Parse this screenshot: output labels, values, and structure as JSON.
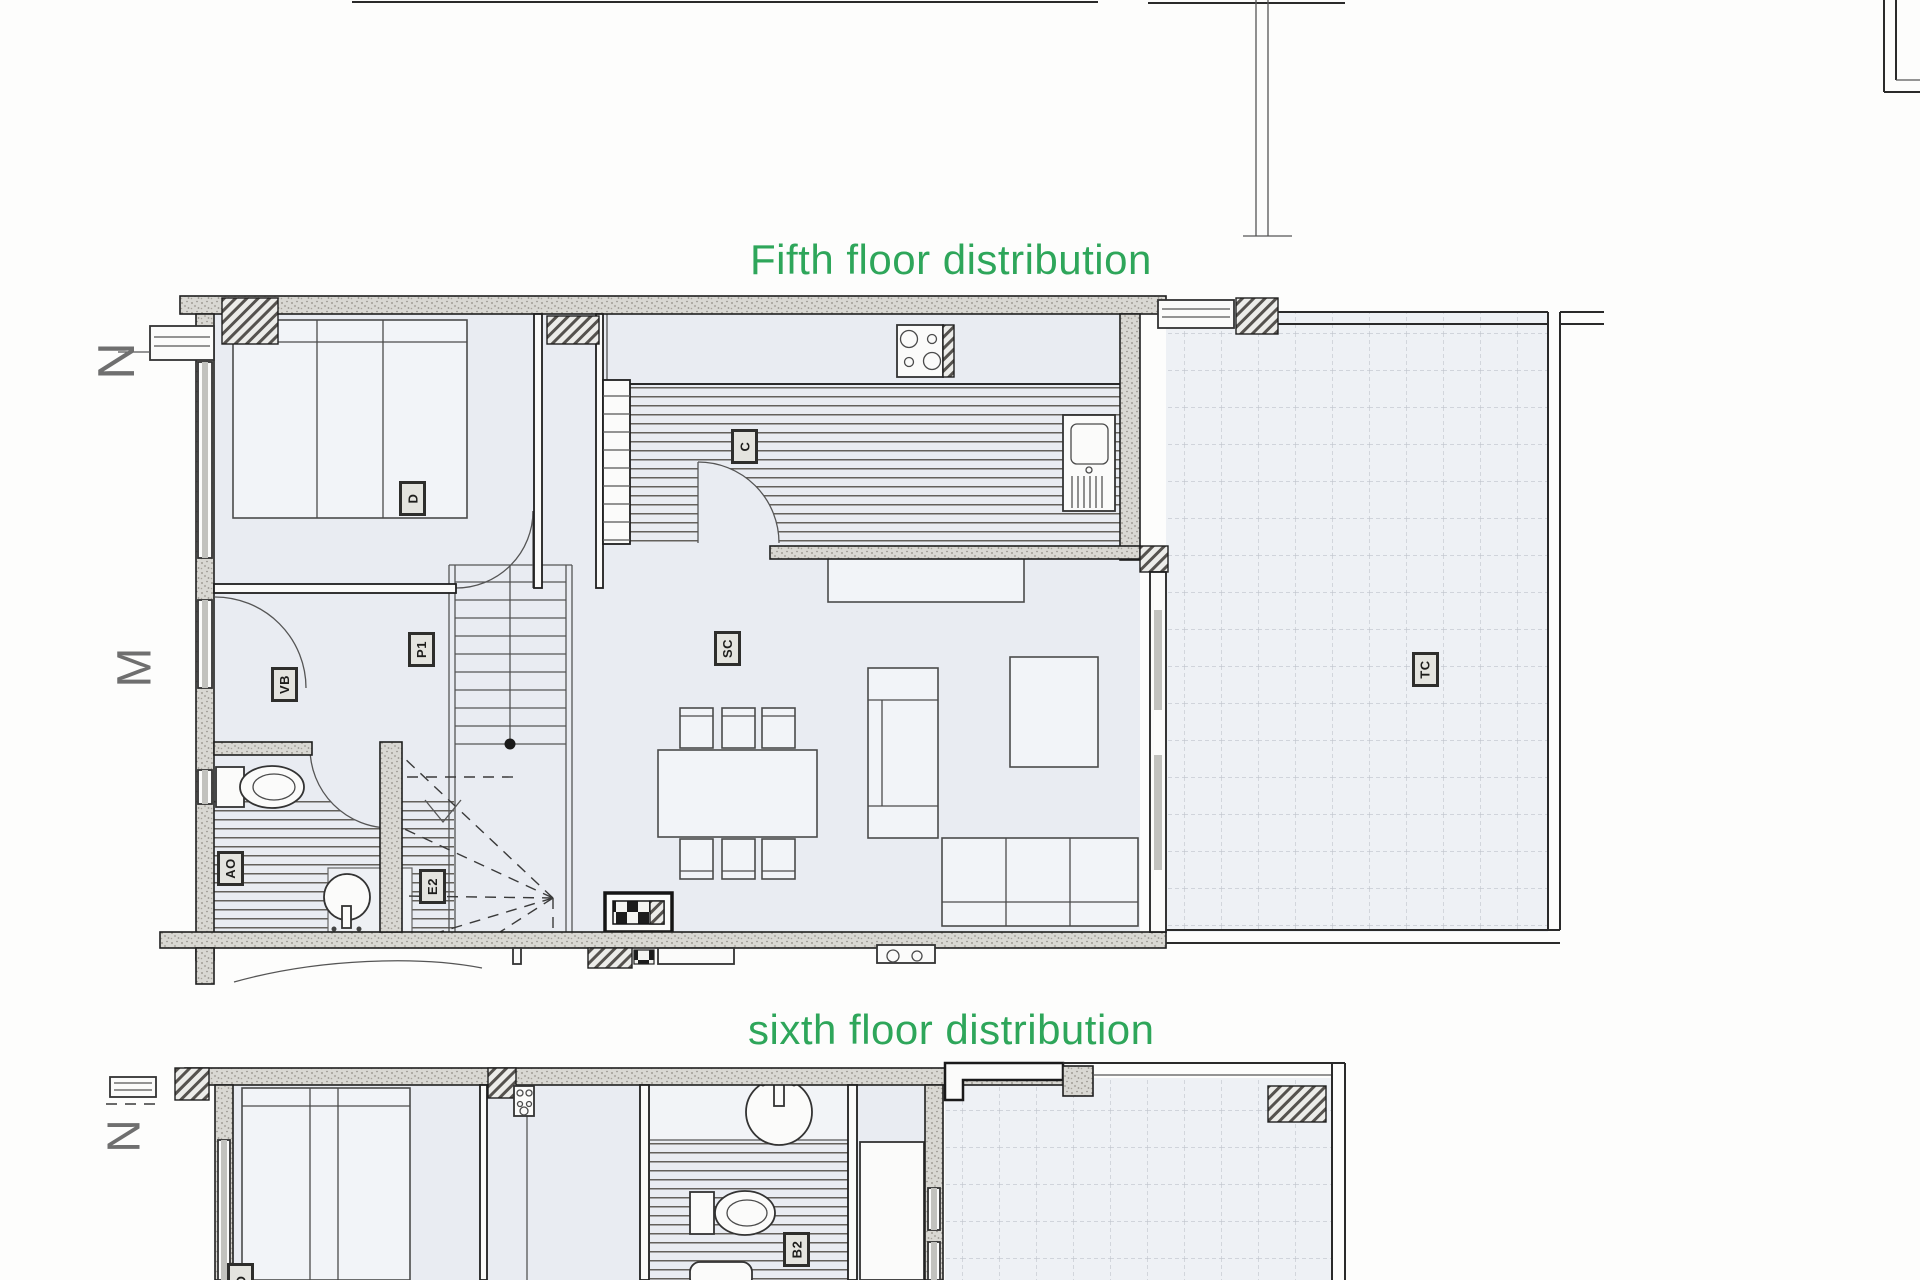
{
  "titles": {
    "fifth": "Fifth floor distribution",
    "sixth": "sixth floor distribution"
  },
  "colors": {
    "title_green": "#2ea65a",
    "paper": "#fdfdfc",
    "room_fill": "#e9ecf2",
    "terrace_fill": "#eef1f5",
    "wall_line": "#1f1f1f",
    "annotation_gray": "#6f6f6f"
  },
  "orientation_letters": [
    {
      "id": "fifth-north",
      "text": "N",
      "x": 88,
      "y": 326,
      "size": 52
    },
    {
      "id": "fifth-west",
      "text": "M",
      "x": 108,
      "y": 634,
      "size": 48
    },
    {
      "id": "sixth-north",
      "text": "N",
      "x": 98,
      "y": 1104,
      "size": 46
    }
  ],
  "room_labels": [
    {
      "id": "fifth-bedroom",
      "text": "D",
      "x": 399,
      "y": 481
    },
    {
      "id": "fifth-hall",
      "text": "P1",
      "x": 408,
      "y": 632
    },
    {
      "id": "fifth-vestibule",
      "text": "VB",
      "x": 271,
      "y": 667
    },
    {
      "id": "fifth-living",
      "text": "SC",
      "x": 714,
      "y": 631
    },
    {
      "id": "fifth-kitchen",
      "text": "C",
      "x": 731,
      "y": 429
    },
    {
      "id": "fifth-terrace",
      "text": "TC",
      "x": 1412,
      "y": 652
    },
    {
      "id": "fifth-bath",
      "text": "AO",
      "x": 217,
      "y": 851
    },
    {
      "id": "fifth-stairs",
      "text": "E2",
      "x": 419,
      "y": 869
    },
    {
      "id": "sixth-bath",
      "text": "B2",
      "x": 783,
      "y": 1232
    },
    {
      "id": "sixth-bedroom",
      "text": "D",
      "x": 227,
      "y": 1263
    }
  ]
}
